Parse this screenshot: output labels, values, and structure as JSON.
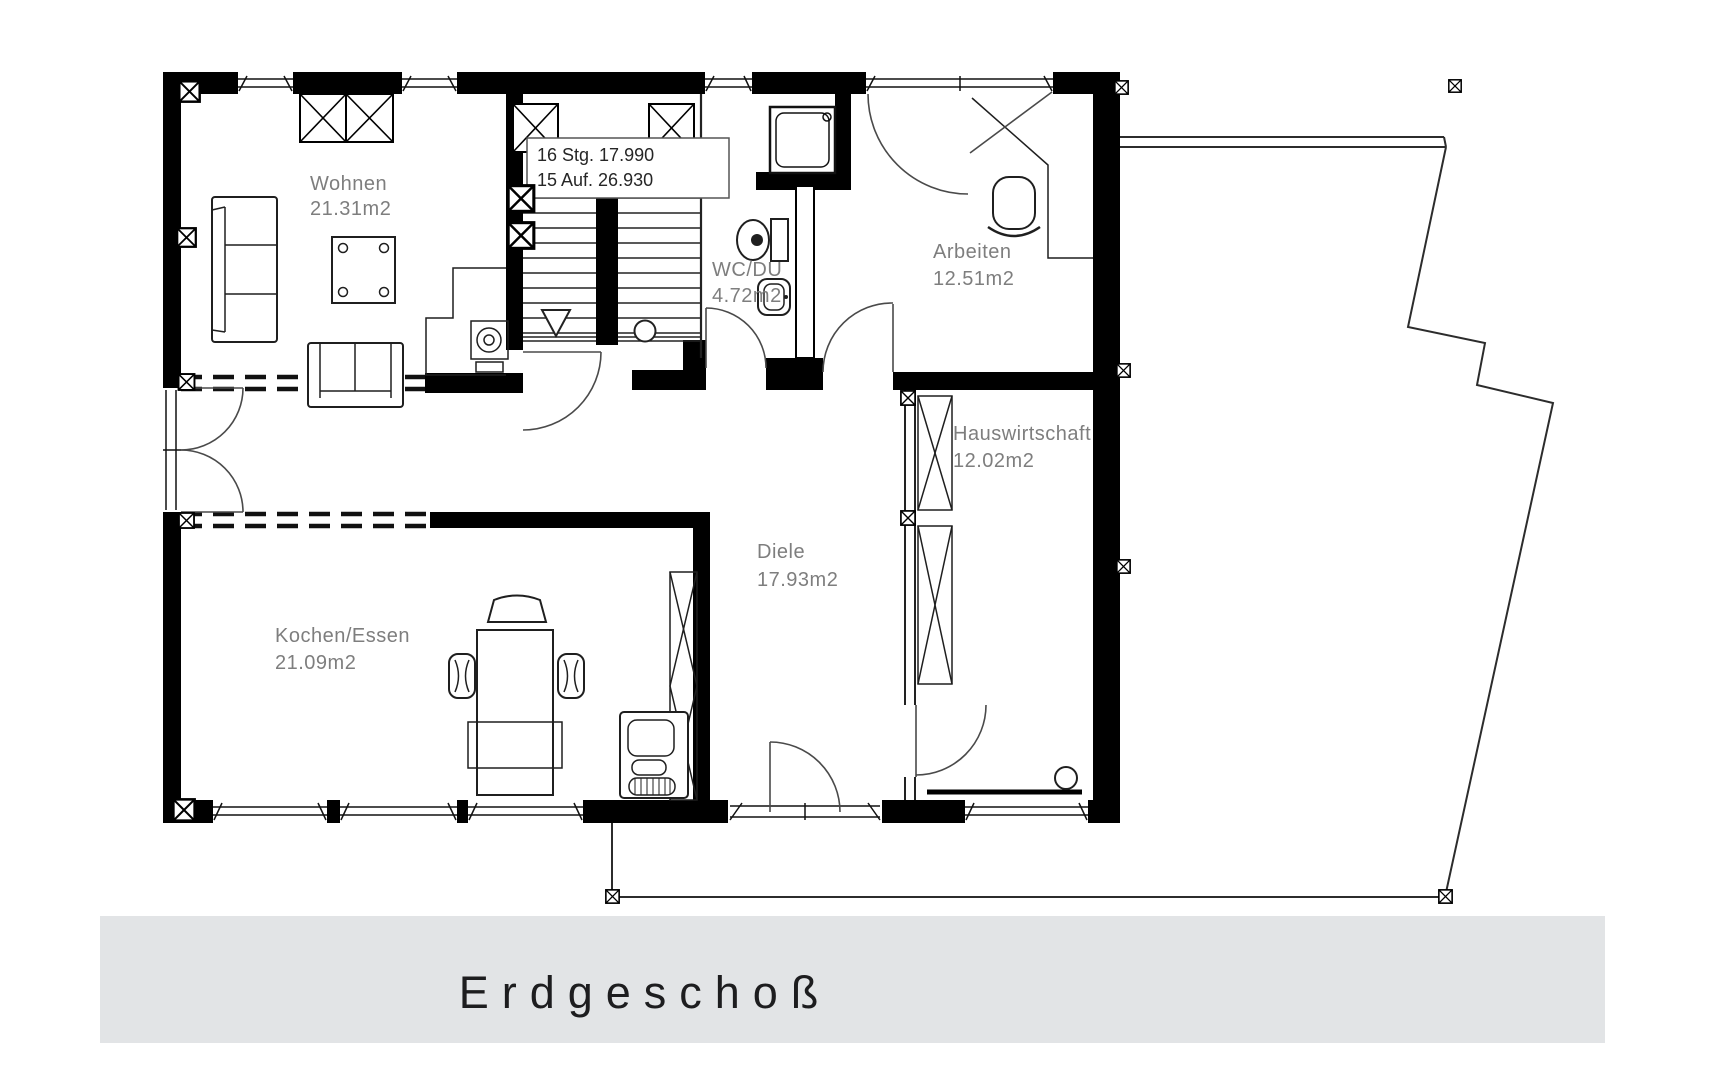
{
  "floor_plan": {
    "title": "Erdgeschoß",
    "rooms": [
      {
        "name": "Wohnen",
        "area": "21.31m2"
      },
      {
        "name": "Kochen/Essen",
        "area": "21.09m2"
      },
      {
        "name": "Diele",
        "area": "17.93m2"
      },
      {
        "name": "WC/DU",
        "area": "4.72m2"
      },
      {
        "name": "Arbeiten",
        "area": "12.51m2"
      },
      {
        "name": "Hauswirtschaft",
        "area": "12.02m2"
      }
    ],
    "staircase": {
      "risers": "16 Stg. 17.990",
      "treads": "15 Auf. 26.930"
    },
    "colors": {
      "wall": "#000000",
      "thin_line": "#2c2c2c",
      "room_label": "#7e7e7e",
      "banner_bg": "#e2e4e6",
      "title_text": "#1d1d1f"
    }
  }
}
